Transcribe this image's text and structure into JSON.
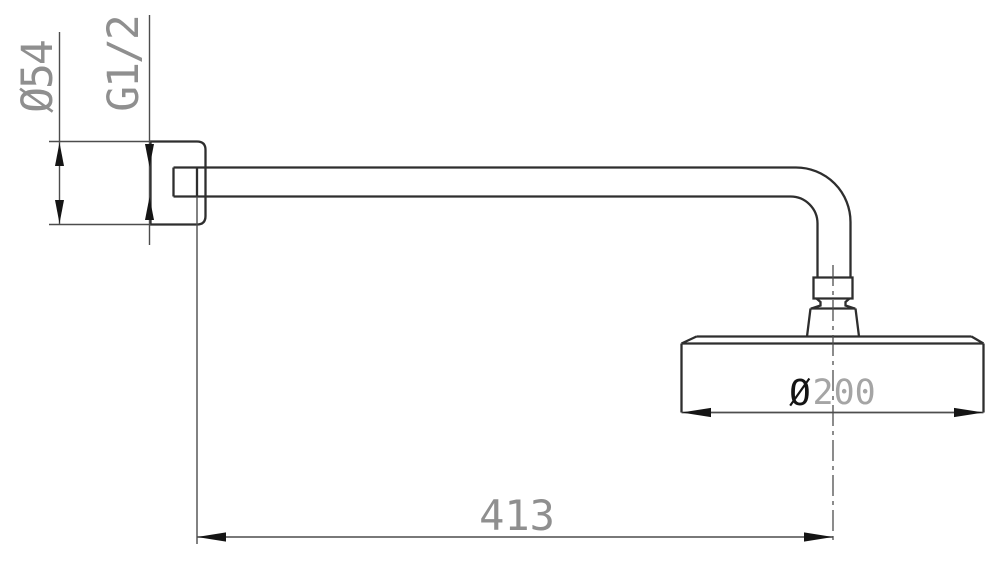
{
  "canvas": {
    "width": 1000,
    "height": 570,
    "background": "#ffffff"
  },
  "drawing_type": "technical dimension drawing, side view",
  "labels": {
    "flange_diameter": "Ø54",
    "thread_size": "G1/2",
    "head_diameter_symbol": "Ø",
    "head_diameter_value": "200",
    "arm_length": "413"
  },
  "colors": {
    "object_line": "#2e2e2e",
    "dimension_line": "#4d4d4d",
    "arrow": "#151515",
    "label_gray": "#8f8f8f",
    "label_light": "#a5a5a5",
    "symbol_dark": "#141414",
    "background": "#ffffff"
  }
}
